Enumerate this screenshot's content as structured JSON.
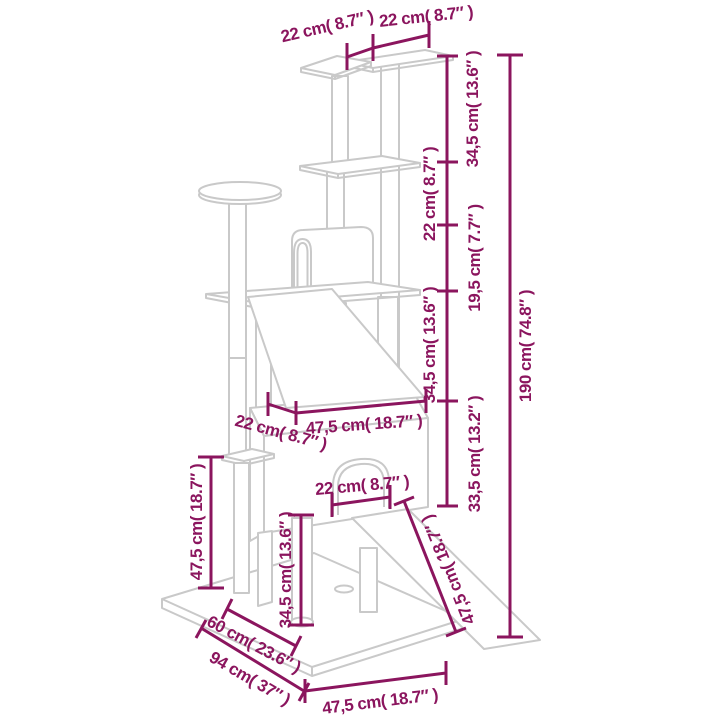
{
  "diagram": {
    "subject": "cat-tree-with-scratching-posts-dimension-diagram",
    "units": "cm and inches"
  },
  "colors": {
    "dimension_accent": "#8b155e",
    "structure_line": "#c9c9c9",
    "background": "#ffffff"
  },
  "dimensions": [
    {
      "name": "top-platform-left-width",
      "label": "22 cm( 8.7″ )"
    },
    {
      "name": "top-platform-right-width",
      "label": "22 cm( 8.7″ )"
    },
    {
      "name": "height-segment-1",
      "label": "34,5 cm( 13.6″ )"
    },
    {
      "name": "height-segment-2",
      "label": "22 cm( 8.7″ )"
    },
    {
      "name": "height-segment-3",
      "label": "19,5 cm( 7.7″ )"
    },
    {
      "name": "height-segment-4",
      "label": "34,5 cm( 13.6″ )"
    },
    {
      "name": "height-segment-5",
      "label": "33,5 cm( 13.2″ )"
    },
    {
      "name": "total-height",
      "label": "190 cm( 74.8″ )"
    },
    {
      "name": "house-top-width",
      "label": "47,5 cm( 18.7″ )"
    },
    {
      "name": "house-top-depth",
      "label": "22 cm( 8.7″ )"
    },
    {
      "name": "door-width",
      "label": "22 cm( 8.7″ )"
    },
    {
      "name": "ramp-length",
      "label": "47,5 cm( 18.7″ )"
    },
    {
      "name": "left-post-height",
      "label": "47,5 cm( 18.7″ )"
    },
    {
      "name": "front-post-height",
      "label": "34,5 cm( 13.6″ )"
    },
    {
      "name": "base-depth",
      "label": "60 cm( 23.6″ )"
    },
    {
      "name": "base-length",
      "label": "94 cm( 37″ )"
    },
    {
      "name": "base-front-width",
      "label": "47,5 cm( 18.7″ )"
    }
  ]
}
